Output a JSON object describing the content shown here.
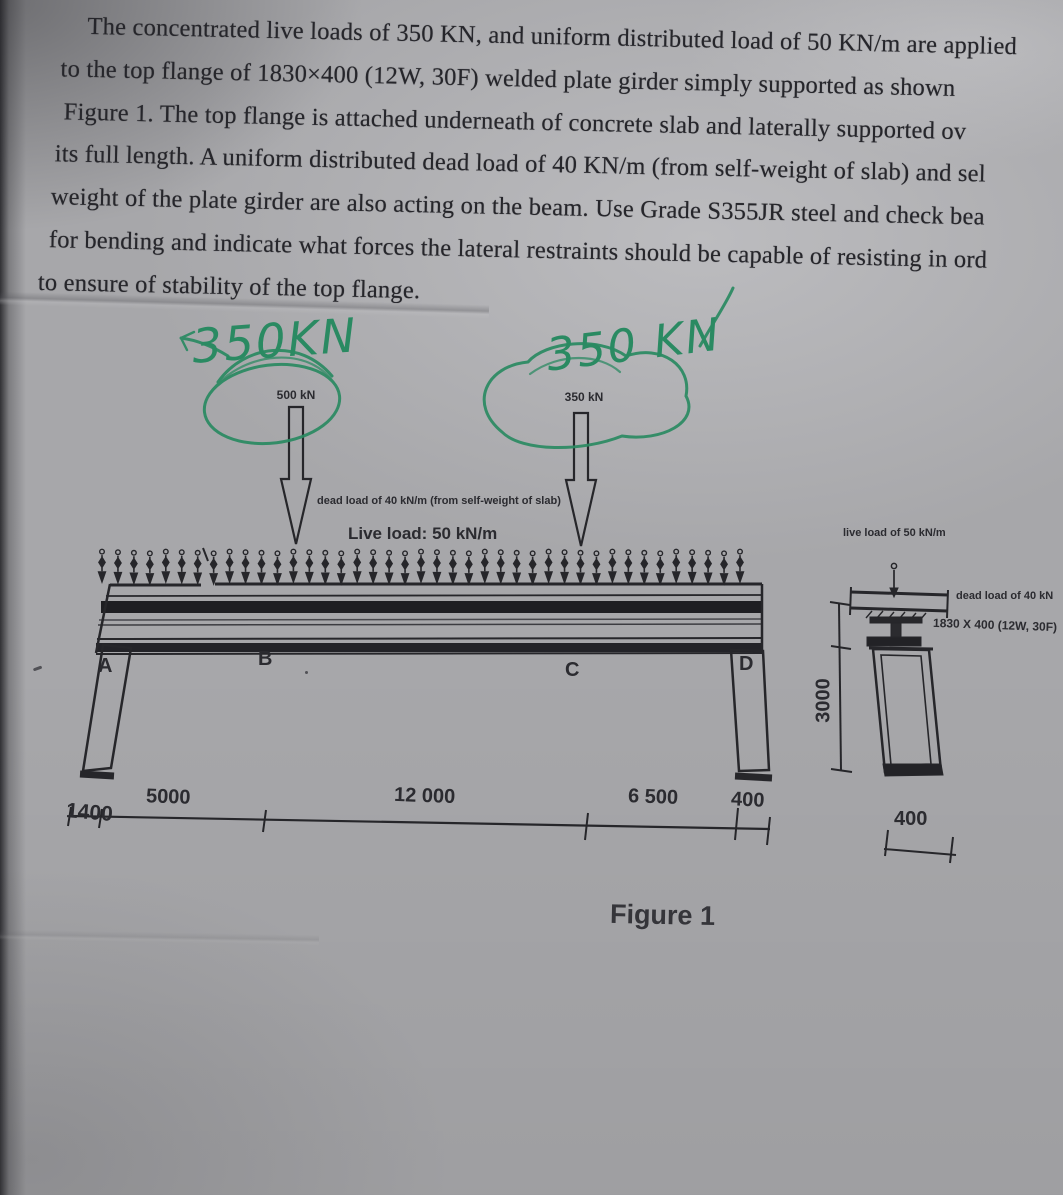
{
  "document": {
    "paragraph_lines": [
      "The concentrated live loads of 350 KN, and uniform distributed load of 50 KN/m are applied",
      "to the top flange of 1830×400 (12W, 30F) welded plate girder simply supported as shown",
      "Figure 1. The top flange is attached underneath of concrete slab and laterally supported ov",
      "its full length. A uniform distributed dead load of 40 KN/m (from self-weight of slab) and sel",
      "weight of the plate girder are also acting on the beam. Use Grade S355JR steel and check bea",
      "for bending and indicate what forces the lateral restraints should be capable of resisting in ord",
      "to ensure of stability of the top flange."
    ]
  },
  "figure": {
    "handwritten": {
      "left_load": "350KN",
      "right_load": "350 KN"
    },
    "point_loads": {
      "left_label": "500 kN",
      "right_label": "350 kN"
    },
    "dead_load_note": "dead load of 40 kN/m (from self-weight of slab)",
    "live_load_label": "Live load: 50 kN/m",
    "supports": [
      "A",
      "B",
      "C",
      "D"
    ],
    "dimensions": {
      "left_overhang": "1400",
      "span_ab": "5000",
      "span_bc": "12 000",
      "span_cd": "6 500",
      "right_overhang": "400"
    },
    "section": {
      "live_load_label": "live load of 50 kN/m",
      "dead_load_label": "dead load of 40 kN",
      "size_label": "1830 X 400 (12W, 30F)",
      "height_dim": "3000",
      "width_dim": "400"
    },
    "caption": "Figure 1",
    "colors": {
      "pen_green": "#2a8a62",
      "ink": "#26262a"
    }
  }
}
